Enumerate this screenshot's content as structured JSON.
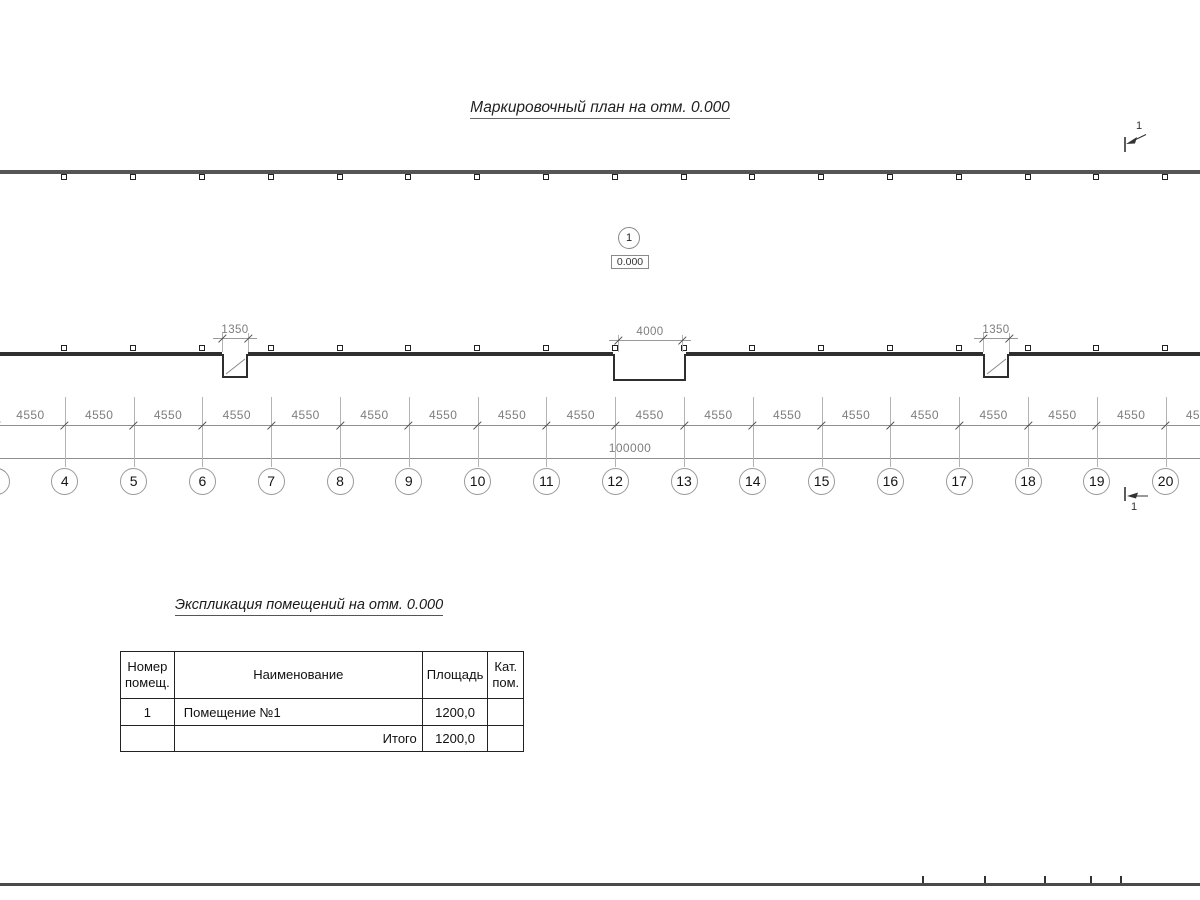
{
  "plan": {
    "title": "Маркировочный план на отм. 0.000",
    "room_marker": {
      "number": "1",
      "elevation": "0.000"
    },
    "section_marks": {
      "top_label": "1",
      "bottom_label": "1"
    },
    "axes": {
      "labels": [
        "3",
        "4",
        "5",
        "6",
        "7",
        "8",
        "9",
        "10",
        "11",
        "12",
        "13",
        "14",
        "15",
        "16",
        "17",
        "18",
        "19",
        "20",
        "21"
      ]
    },
    "dimensions": {
      "bay": "4550",
      "total": "100000",
      "openings": [
        "1350",
        "4000",
        "1350"
      ]
    }
  },
  "schedule": {
    "title": "Экспликация помещений на отм. 0.000",
    "headers": {
      "number_l1": "Номер",
      "number_l2": "помещ.",
      "name": "Наименование",
      "area": "Площадь",
      "category_l1": "Кат.",
      "category_l2": "пом."
    },
    "rows": [
      {
        "number": "1",
        "name": "Помещение №1",
        "area": "1200,0",
        "category": ""
      }
    ],
    "total": {
      "label": "Итого",
      "value": "1200,0"
    }
  }
}
